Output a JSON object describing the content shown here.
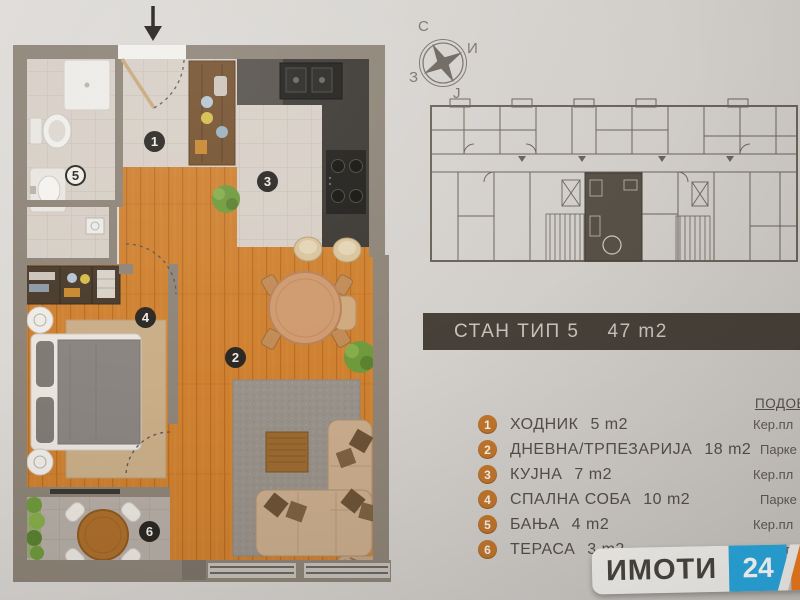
{
  "title_bar": {
    "label": "СТАН ТИП 5",
    "area": "47 m2",
    "bg": "#474038"
  },
  "compass": {
    "n": "С",
    "e": "И",
    "w": "З",
    "s": "Ј"
  },
  "legend": {
    "floor_header": "ПОДОВ",
    "badge_color": "#c0762c",
    "rooms": [
      {
        "num": "1",
        "name": "ХОДНИК",
        "area": "5 m2",
        "floor": "Кер.пл"
      },
      {
        "num": "2",
        "name": "ДНЕВНА/ТРПЕЗАРИЈА",
        "area": "18 m2",
        "floor": "Парке"
      },
      {
        "num": "3",
        "name": "КУЈНА",
        "area": "7 m2",
        "floor": "Кер.пл"
      },
      {
        "num": "4",
        "name": "СПАЛНА СОБА",
        "area": "10 m2",
        "floor": "Парке"
      },
      {
        "num": "5",
        "name": "БАЊА",
        "area": "4 m2",
        "floor": "Кер.пл"
      },
      {
        "num": "6",
        "name": "ТЕРАСА",
        "area": "3 m2",
        "floor": "Кер.пл"
      }
    ]
  },
  "logo": {
    "name": "ИМОТИ",
    "num_24": "24",
    "num_7": "7",
    "blue": "#2aa9e0",
    "orange": "#ef7c22"
  }
}
